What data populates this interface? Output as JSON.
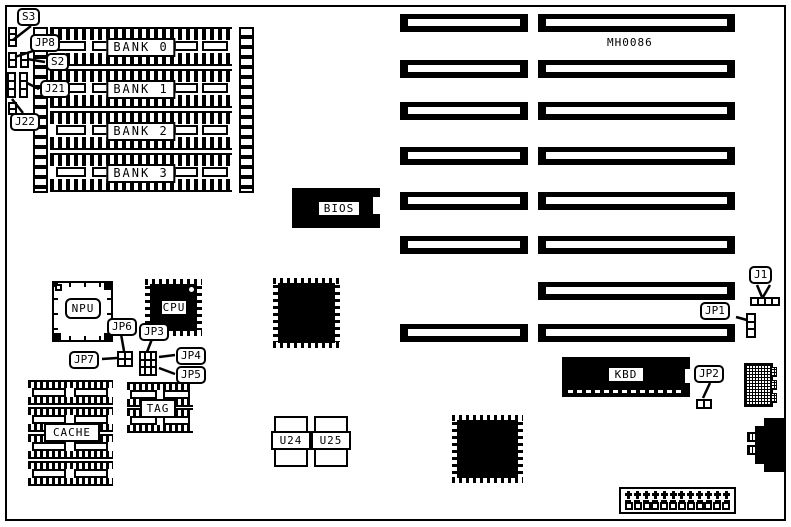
{
  "board_id": "MH0086",
  "memory": {
    "banks": [
      "BANK 0",
      "BANK 1",
      "BANK 2",
      "BANK 3"
    ]
  },
  "chips": {
    "bios": "BIOS",
    "npu": "NPU",
    "cpu": "CPU",
    "kbd": "KBD",
    "cache": "CACHE",
    "tag": "TAG",
    "u24": "U24",
    "u25": "U25"
  },
  "jumpers": {
    "s3": "S3",
    "jp8": "JP8",
    "s2": "S2",
    "j21": "J21",
    "j22": "J22",
    "jp6": "JP6",
    "jp3": "JP3",
    "jp7": "JP7",
    "jp4": "JP4",
    "jp5": "JP5",
    "j1": "J1",
    "jp1": "JP1",
    "jp2": "JP2"
  },
  "colors": {
    "ink": "#000000",
    "paper": "#ffffff"
  }
}
